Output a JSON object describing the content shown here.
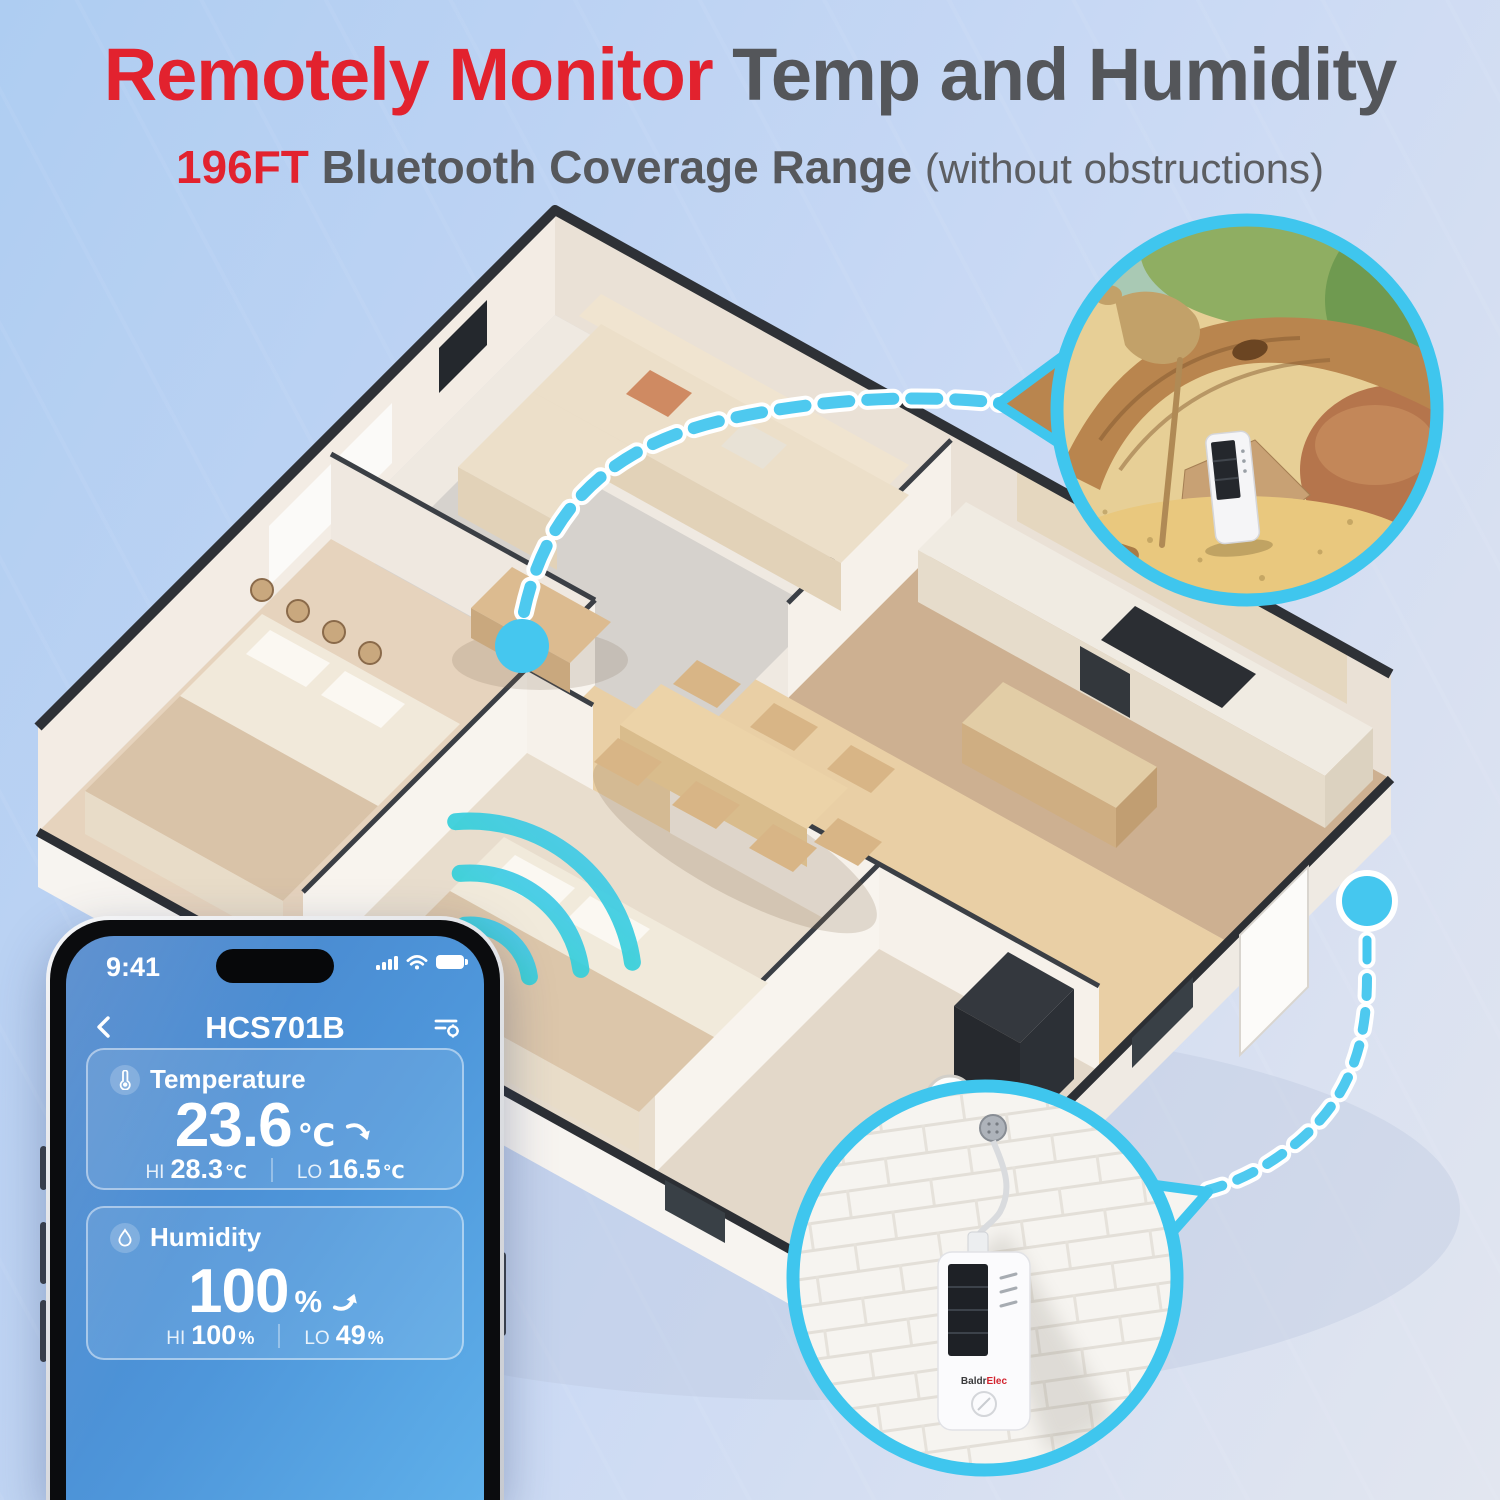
{
  "header": {
    "title_highlight": "Remotely Monitor",
    "title_rest": " Temp and Humidity",
    "subtitle_highlight": "196FT",
    "subtitle_main": " Bluetooth Coverage Range ",
    "subtitle_note": "(without obstructions)"
  },
  "phone": {
    "status_bar": {
      "time": "9:41"
    },
    "nav": {
      "title": "HCS701B"
    },
    "cards": {
      "temperature": {
        "label": "Temperature",
        "value": "23.6",
        "unit": "℃",
        "trend": "down",
        "hi_label": "HI",
        "hi_value": "28.3",
        "hi_unit": "℃",
        "lo_label": "LO",
        "lo_value": "16.5",
        "lo_unit": "℃"
      },
      "humidity": {
        "label": "Humidity",
        "value": "100",
        "unit": "%",
        "trend": "up",
        "hi_label": "HI",
        "hi_value": "100",
        "hi_unit": "%",
        "lo_label": "LO",
        "lo_value": "49",
        "lo_unit": "%"
      }
    }
  },
  "callouts": {
    "wall_device": {
      "brand_dark": "Baldr",
      "brand_red": "Elec"
    }
  },
  "colors": {
    "accent_cyan": "#45c7ef",
    "brand_red": "#e2222e",
    "title_gray": "#54565a",
    "screen_blue_top": "#4680c8",
    "screen_blue_bottom": "#5fb0ea"
  },
  "icons": {
    "back": "chevron-left",
    "settings": "filter-gear",
    "signal": "signal-bars",
    "wifi": "wifi",
    "battery": "battery-full",
    "temperature": "thermometer",
    "humidity": "droplet",
    "trend_down": "curved-arrow-down",
    "trend_up": "curved-arrow-up",
    "sensor_dot": "bluetooth-sensor-dot"
  }
}
